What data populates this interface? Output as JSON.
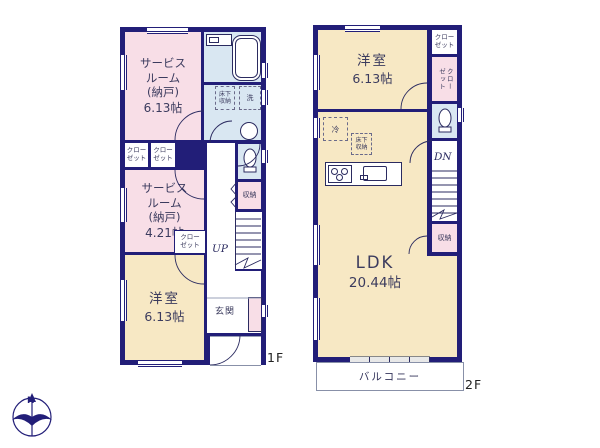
{
  "colors": {
    "wall": "#221e78",
    "room_pink": "#f8dee7",
    "room_yellow": "#f7e8c4",
    "room_blue": "#d9e7f2",
    "label_text": "#3b3b5e"
  },
  "floor1": {
    "label": "1F",
    "service_room_1": {
      "name": "サービス\nルーム\n(納戸)",
      "size": "6.13帖"
    },
    "service_room_2": {
      "name": "サービス\nルーム\n(納戸)",
      "size": "4.21帖"
    },
    "western_room": {
      "name": "洋室",
      "size": "6.13帖"
    },
    "entrance_label": "玄関",
    "closet_label": "クロー\nゼット",
    "storage_label": "収納",
    "underfloor_storage_label": "床下\n収納",
    "washer_label": "洗",
    "up_label": "UP"
  },
  "floor2": {
    "label": "2F",
    "western_room": {
      "name": "洋室",
      "size": "6.13帖"
    },
    "ldk": {
      "name": "LDK",
      "size": "20.44帖"
    },
    "closet_top_label": "クロー\nゼット",
    "closet_side_label": "クローゼット",
    "storage_label": "収納",
    "underfloor_storage_label": "床下\n収納",
    "fridge_label": "冷",
    "dn_label": "DN",
    "balcony_label": "バルコニー"
  },
  "compass": {
    "north_label": "N"
  }
}
